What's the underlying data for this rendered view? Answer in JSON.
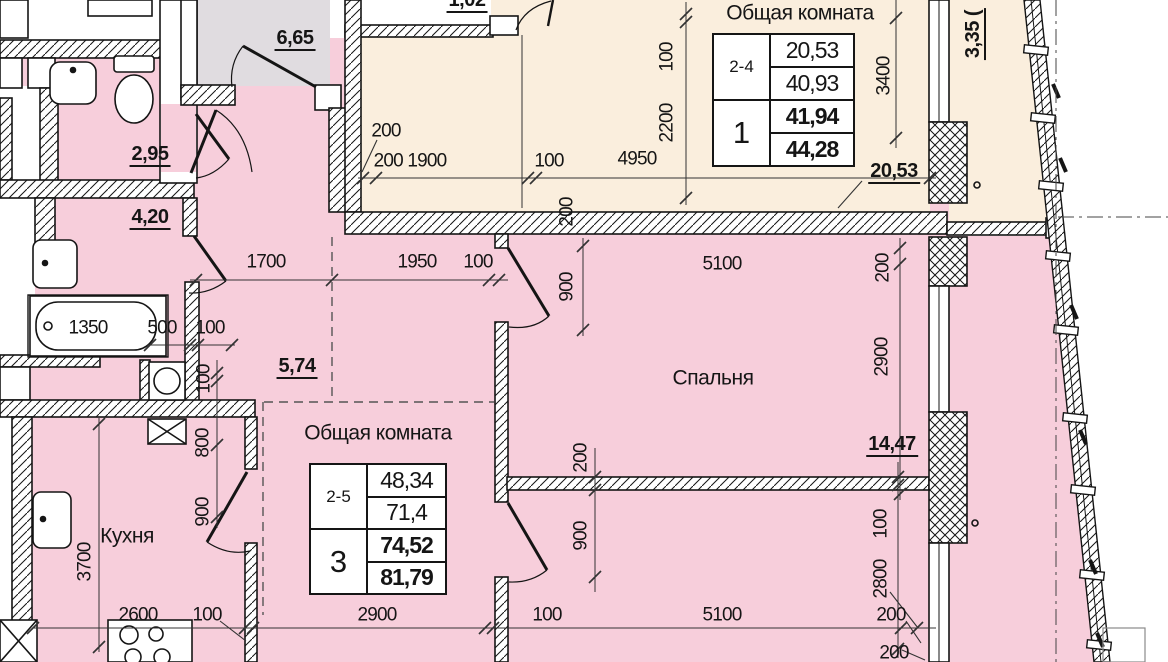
{
  "colors": {
    "pink": "#f7cedb",
    "beige": "#faeedd",
    "gray": "#e0dce0",
    "line": "#151515"
  },
  "rooms": {
    "living_room_1": "Общая комната",
    "living_room_3": "Общая комната",
    "bedroom": "Спальня",
    "kitchen": "Кухня"
  },
  "areas": {
    "stair_hall": "6,65",
    "bathroom": "2,95",
    "corridor": "4,20",
    "hallway": "5,74",
    "living1": "20,53",
    "bedroom": "14,47",
    "storage": "1,02",
    "balcony": "3,35 ("
  },
  "tables": {
    "apartment1": {
      "range": "2-4",
      "number": "1",
      "rows": [
        "20,53",
        "40,93",
        "41,94",
        "44,28"
      ]
    },
    "apartment3": {
      "range": "2-5",
      "number": "3",
      "rows": [
        "48,34",
        "71,4",
        "74,52",
        "81,79"
      ]
    }
  },
  "dims_h": [
    "200",
    "200 1900",
    "100",
    "4950",
    "1700",
    "1950",
    "100",
    "5100",
    "1350",
    "500",
    "100",
    "2600",
    "100",
    "2900",
    "100",
    "5100",
    "200",
    "200"
  ],
  "dims_v": [
    "100",
    "2200",
    "3400",
    "200",
    "900",
    "200",
    "2900",
    "100",
    "800",
    "900",
    "3700",
    "200",
    "900",
    "100",
    "2800"
  ]
}
